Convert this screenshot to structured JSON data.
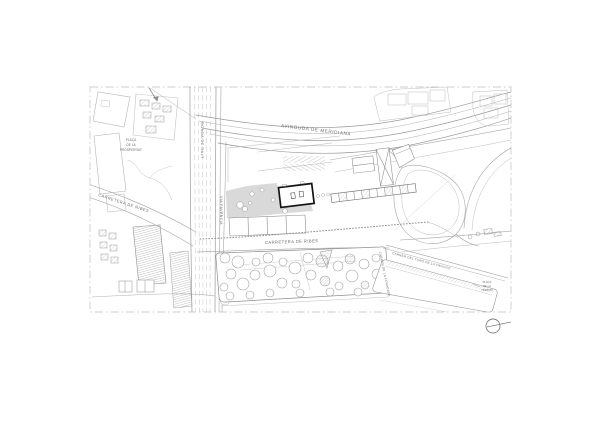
{
  "colors": {
    "background": "#ffffff",
    "trim_border": "#cccccc",
    "linework": "#9a9a9a",
    "linework_light": "#c0c0c0",
    "label_text": "#5f5f5f",
    "plaza_fill": "#d9d9d9",
    "project_building_stroke": "#141414"
  },
  "map": {
    "streets": {
      "avinguda_meridiana": "AVINGUDA DE MERIDIANA",
      "ronda_de_dalt": "RONDA DE DALT",
      "via_favencia": "VIA FAVÈNCIA",
      "carretera_de_ribes": "CARRETERA DE RIBES",
      "carretera_de_ribes_west": "CARRETERA DE RIBES",
      "carrer_turo_trinitat": "CARRER DEL TURÓ DE LA TRINITAT",
      "carrer_foradada": "CARRER DE LA FORADADA"
    },
    "places": {
      "placa_prosperitat": {
        "l1": "PLAÇA",
        "l2": "DE LA",
        "l3": "PROSPERITAT"
      },
      "placa_trinitat": {
        "l1": "PLAÇA",
        "l2": "DE LA",
        "l3": "TRINITAT"
      }
    },
    "icons": {
      "orientation_marker": "circle-with-line"
    }
  }
}
